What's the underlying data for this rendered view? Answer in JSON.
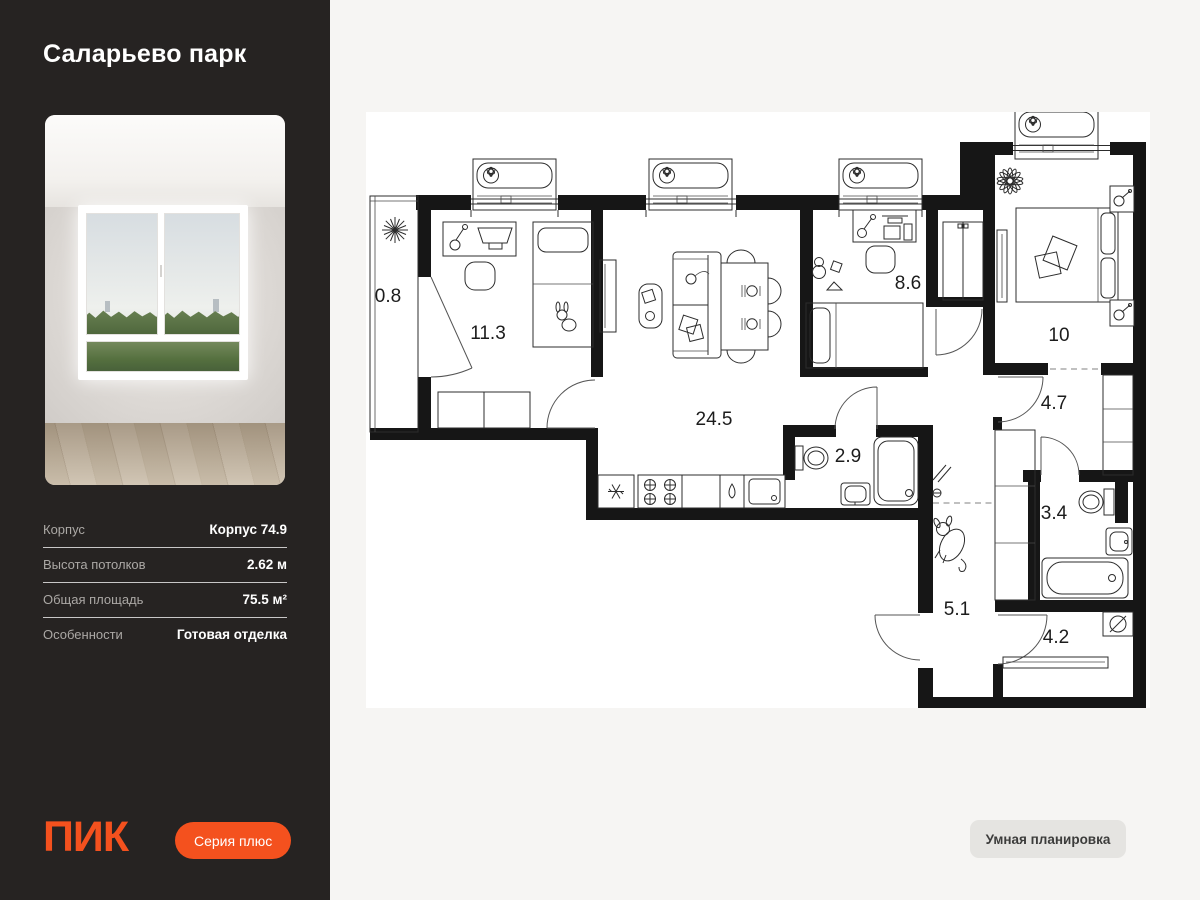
{
  "sidebar": {
    "title": "Саларьево парк",
    "details": [
      {
        "label": "Корпус",
        "value": "Корпус 74.9"
      },
      {
        "label": "Высота потолков",
        "value": "2.62 м"
      },
      {
        "label": "Общая площадь",
        "value": "75.5 м²"
      },
      {
        "label": "Особенности",
        "value": "Готовая отделка"
      }
    ],
    "logo": "ПИК",
    "series_button": "Серия плюс"
  },
  "plan": {
    "rooms": [
      {
        "name": "balcony",
        "area": "0.8"
      },
      {
        "name": "bedroom-1",
        "area": "11.3"
      },
      {
        "name": "living-kitchen",
        "area": "24.5"
      },
      {
        "name": "bedroom-2",
        "area": "8.6"
      },
      {
        "name": "bedroom-3",
        "area": "10"
      },
      {
        "name": "corridor",
        "area": "4.7"
      },
      {
        "name": "bathroom-1",
        "area": "2.9"
      },
      {
        "name": "bathroom-2",
        "area": "3.4"
      },
      {
        "name": "hallway",
        "area": "5.1"
      },
      {
        "name": "entry",
        "area": "4.2"
      }
    ],
    "smart_button": "Умная планировка"
  },
  "colors": {
    "accent": "#F4511E",
    "sidebar_bg": "#262322",
    "page_bg": "#F6F5F3",
    "plan_ink": "#161616"
  }
}
